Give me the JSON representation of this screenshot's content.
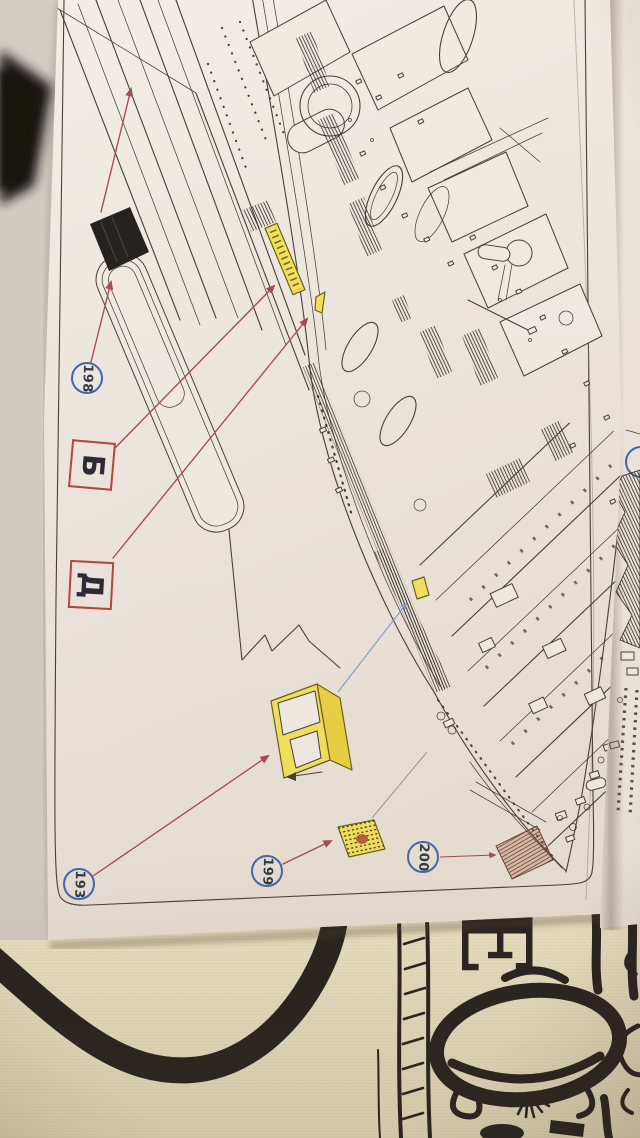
{
  "callouts": {
    "c198": {
      "label": "198"
    },
    "cb": {
      "label": "Б"
    },
    "cd": {
      "label": "Д"
    },
    "c193": {
      "label": "193"
    },
    "c199": {
      "label": "199"
    },
    "c200": {
      "label": "200"
    }
  },
  "fabric": {
    "letter": "Е"
  },
  "colors": {
    "bgGray": "#d7d1c9",
    "paper": "#f0eae3",
    "ink": "#46403a",
    "inkDark": "#2c2824",
    "arrowRed": "#a84a52",
    "calloutBlue": "#4565a8",
    "calloutRed": "#b4463e",
    "calloutText": "#333a47",
    "letterText": "#2c2a35",
    "partYellow": "#f2e05e",
    "partYellowDeep": "#eAd044",
    "partBlack": "#262220",
    "partBrown": "#7c4834",
    "blueLine": "#7b9cc8",
    "fabricCream": "#ebe2c4",
    "fabricInk": "#292420",
    "blackFabric": "#1b1815"
  }
}
